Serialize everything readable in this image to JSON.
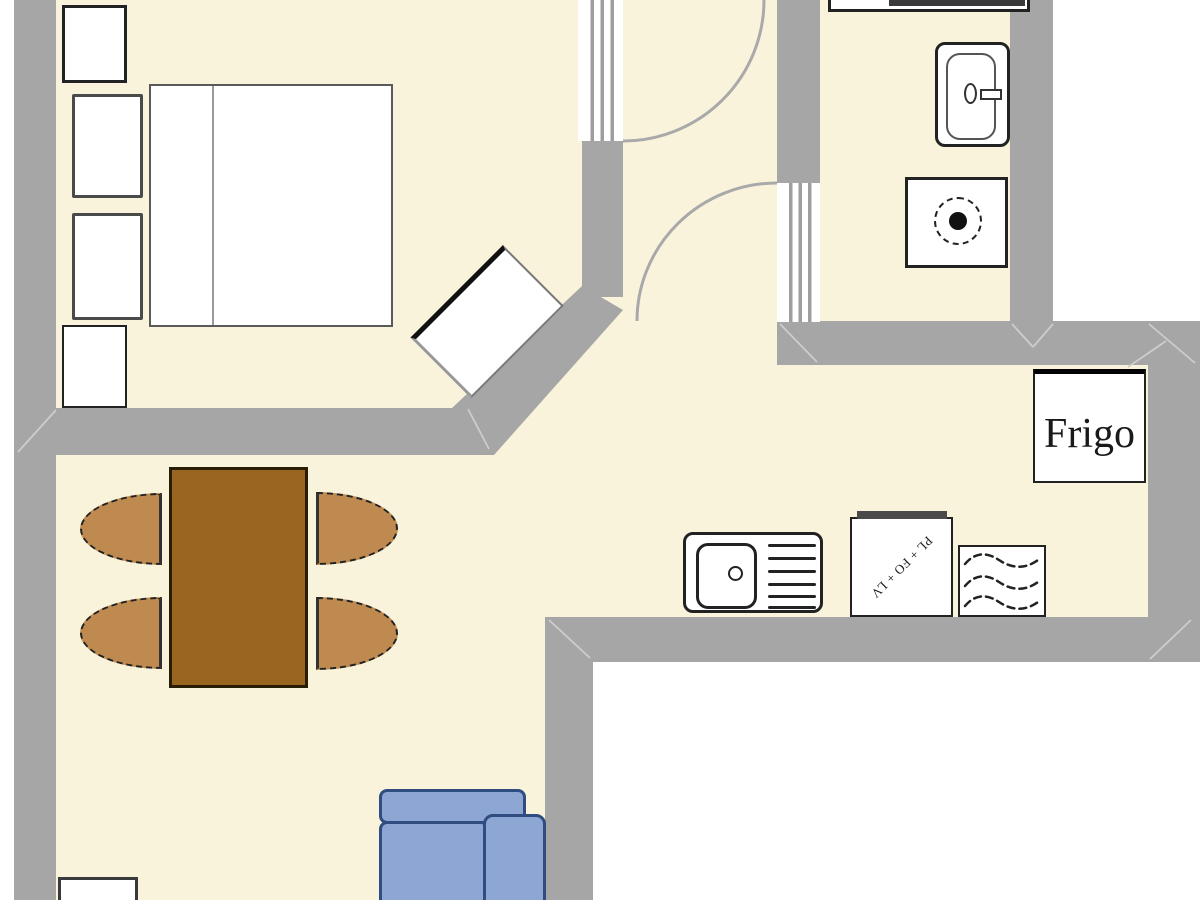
{
  "title": "apartment-floor-plan",
  "labels": {
    "fridge": "Frigo",
    "stove": "PL + FO + LV"
  },
  "colors": {
    "floor": "#FAF3DB",
    "outside": "#FFFFFF",
    "wall": "#A6A6A6",
    "wall-seam": "#CDCDCD",
    "door-arc": "#A9A9A9",
    "door-stripe": "#9E9E9E",
    "outline": "#222222",
    "outline-soft": "#555555",
    "table": "#9A6521",
    "table-border": "#2A1D06",
    "chair": "#BF8A50",
    "chair-border": "#222222",
    "sofa": "#8EA6D4",
    "sofa-border": "#2F4D80",
    "label-text": "#1A1A1A"
  },
  "furniture": {
    "bedroom": [
      "nightstand-top",
      "pillows",
      "double-bed",
      "corner-desk",
      "nightstand-bottom"
    ],
    "bathroom": [
      "vanity",
      "toilet",
      "washing-machine"
    ],
    "hall": [
      "bedroom-door",
      "bathroom-door"
    ],
    "kitchen": [
      "sink",
      "stove",
      "dishwasher",
      "fridge"
    ],
    "living": [
      "dining-table",
      "four-chairs",
      "sofa",
      "low-cabinet"
    ]
  }
}
